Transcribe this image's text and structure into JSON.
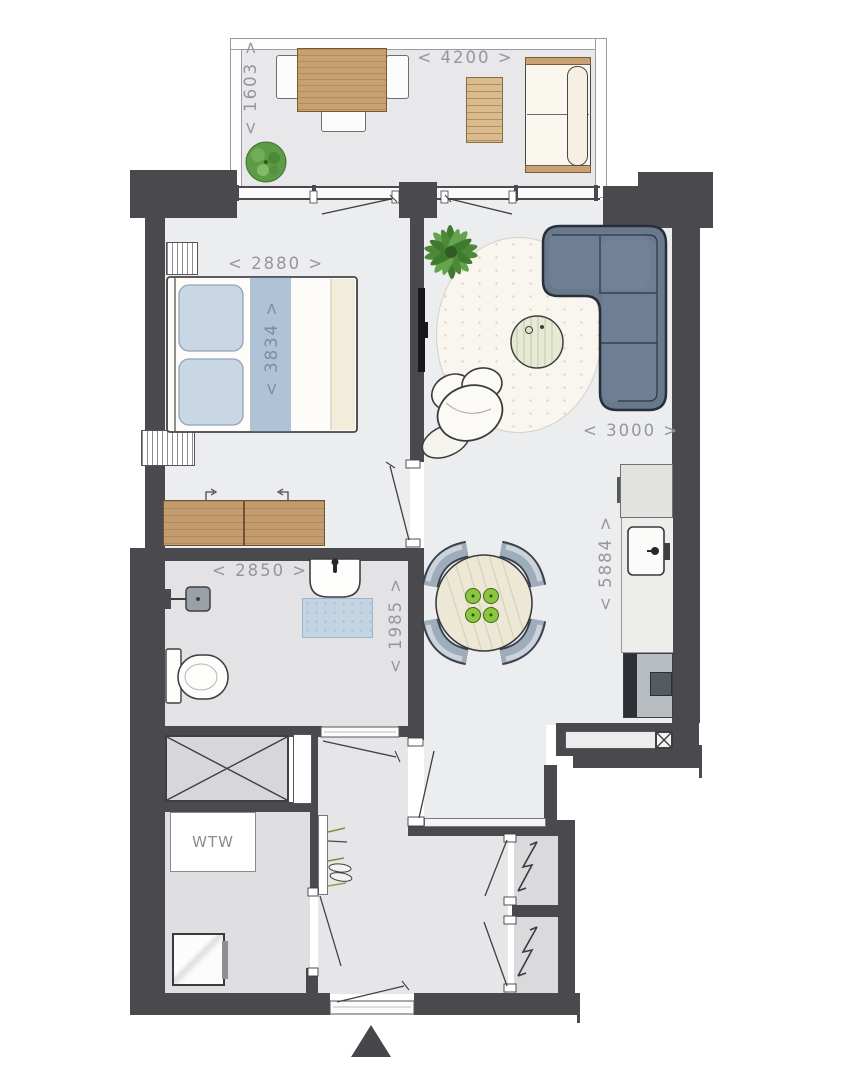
{
  "title": "apartment-floorplan",
  "labels": {
    "ventilation_unit": "WTW"
  },
  "dimensions": {
    "balcony": {
      "width": "< 4200 >",
      "depth": "< 1603 >"
    },
    "bedroom": {
      "width": "< 2880 >",
      "depth": "< 3834 >"
    },
    "living_room": {
      "width": "< 3000 >",
      "depth": "< 5884 >"
    },
    "bathroom": {
      "width": "< 2850 >",
      "depth": "< 1985 >"
    }
  },
  "icons": {
    "north_arrow": "triangle-up",
    "electrical_shaft": "lightning-bolt",
    "ventilation_shaft": "crossed-box",
    "storage_shaft": "crossed-box"
  },
  "palette": {
    "wall": "#4a4a4e",
    "floor": "#ecedef",
    "floor_service": "#dfdfe1",
    "wood": "#c8a171",
    "sofa": "#68798c",
    "sofa_outline": "#272f3a",
    "pillow": "#c9d6e4",
    "bed_runner": "#b0c2d6",
    "bath_mat": "#c3d4e3",
    "dining_chair": "#9fadbb",
    "apple_green": "#8bc63f",
    "plant_green": "#4d8a38",
    "rug": "#f8f6ee",
    "dimension_text": "#96969b"
  }
}
